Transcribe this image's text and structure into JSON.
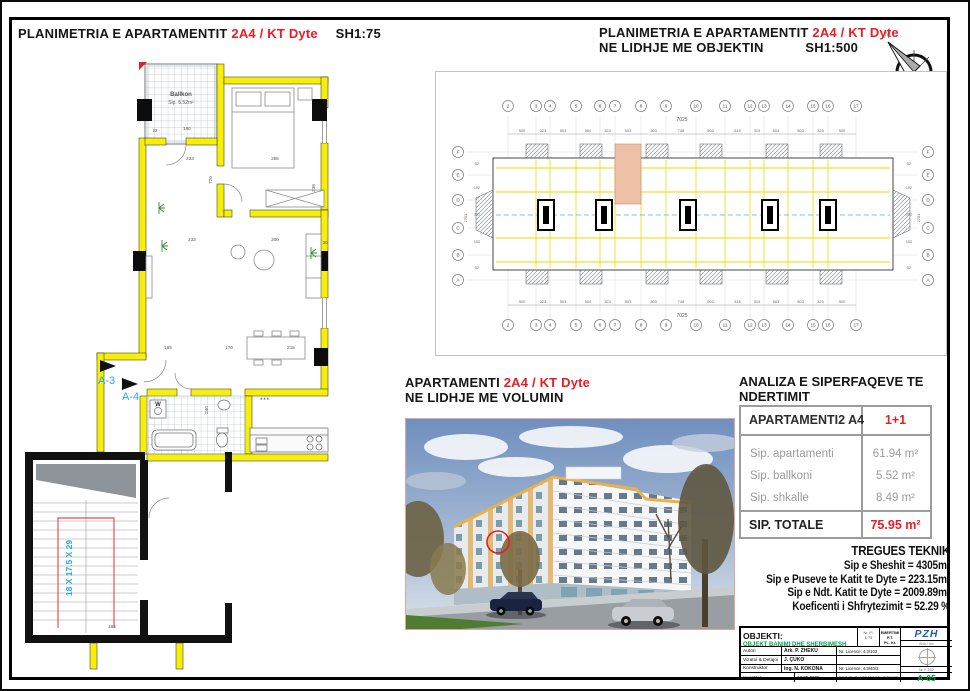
{
  "colors": {
    "accent_red": "#ed1c24",
    "stamp_green": "#00a651",
    "logo_blue": "#1b5fae",
    "wall_yellow": "#f7ef0a",
    "highlight_salmon": "#eec0a6",
    "annotation_cyan": "#2ba7de"
  },
  "panel_detail": {
    "title": {
      "prefix": "PLANIMETRIA E APARTAMENTIT",
      "unit": "2A4 / KT Dyte",
      "scale": "SH1:75"
    },
    "balcony": {
      "name": "Ballkon",
      "area": "Sip. 5.52m²"
    },
    "stairs_label": "18 X 17.5 X 29",
    "section_marks": [
      "A-3",
      "A-4"
    ],
    "washer": "W",
    "fixture_note": "***",
    "dims": [
      "190",
      "22",
      "233",
      "288",
      "720",
      "238",
      "233",
      "300",
      "30",
      "165",
      "170",
      "215",
      "240",
      "165"
    ]
  },
  "panel_overview": {
    "title": {
      "prefix": "PLANIMETRIA E APARTAMENTIT",
      "unit": "2A4 / KT Dyte",
      "line2": "NE LIDHJE ME OBJEKTIN",
      "scale": "SH1:500"
    },
    "compass": "N",
    "grid_cols": [
      "2",
      "3",
      "4",
      "5",
      "6",
      "7",
      "8",
      "9",
      "10",
      "11",
      "12",
      "13",
      "14",
      "15",
      "16",
      "17"
    ],
    "grid_rows": [
      "F",
      "E",
      "D",
      "C",
      "B",
      "A"
    ],
    "total_dim": "7025",
    "side_total": "2701",
    "segment_dims": [
      "500",
      "323",
      "503",
      "500",
      "323",
      "503",
      "303",
      "748",
      "503",
      "515",
      "315",
      "503",
      "503",
      "323",
      "500"
    ],
    "side_dims": [
      "52",
      "152",
      "301",
      "152",
      "52"
    ]
  },
  "panel_volume": {
    "title": {
      "prefix": "APARTAMENTI",
      "unit": "2A4 / KT Dyte",
      "line2": "NE LIDHJE ME VOLUMIN"
    }
  },
  "analysis": {
    "title_line1": "ANALIZA E SIPERFAQEVE TE",
    "title_line2": "NDERTIMIT",
    "header": {
      "name": "APARTAMENTI2 A4",
      "type": "1+1"
    },
    "rows": [
      {
        "label": "Sip. apartamenti",
        "value": "61.94 m²"
      },
      {
        "label": "Sip. ballkoni",
        "value": "5.52 m²"
      },
      {
        "label": "Sip. shkalle",
        "value": "8.49 m²"
      }
    ],
    "total": {
      "label": "SIP. TOTALE",
      "value": "75.95 m²"
    }
  },
  "tregues": {
    "title": "TREGUES TEKNIK",
    "lines": [
      "Sip e Sheshit = 4305m²",
      "Sip e Puseve te Katit te Dyte = 223.15m²",
      "Sip e Ndt. Katit te Dyte = 2009.89m²",
      "Koeficenti i Shfrytezimit = 52.29 %"
    ]
  },
  "titleblock": {
    "objekti_label": "OBJEKTI:",
    "objekti_value": "OBJEKT BANIMI DHE SHERBIMESH",
    "sheet_cell": {
      "line1": "Nr. Fl.",
      "line2": "1:75"
    },
    "emertimi": {
      "line1": "EMERTIMI P.T.",
      "line2": "PL. Kt. DYTE"
    },
    "rows": [
      {
        "label": "Autori",
        "value": "Ark. P. ZHEKU",
        "licence": "Nr. Licence: 4.3/103"
      },
      {
        "label": "Vizatoi & Detajoi",
        "value": "J. ÇUKO",
        "licence": ""
      },
      {
        "label": "Konstruktor",
        "value": "Ing. N. KOKONA",
        "licence": "Nr. Licence: 4.3/40/3"
      }
    ],
    "bottom": {
      "label": "Investitor",
      "date": "17.09.2009",
      "note": "PROJEKTI I ZBATIMIT - TIRANE"
    },
    "logo": {
      "text": "PZH",
      "sub": "Arch / Inc",
      "stamp_no": "Nr. F. 2/02"
    },
    "sheet_no": "A-05"
  }
}
